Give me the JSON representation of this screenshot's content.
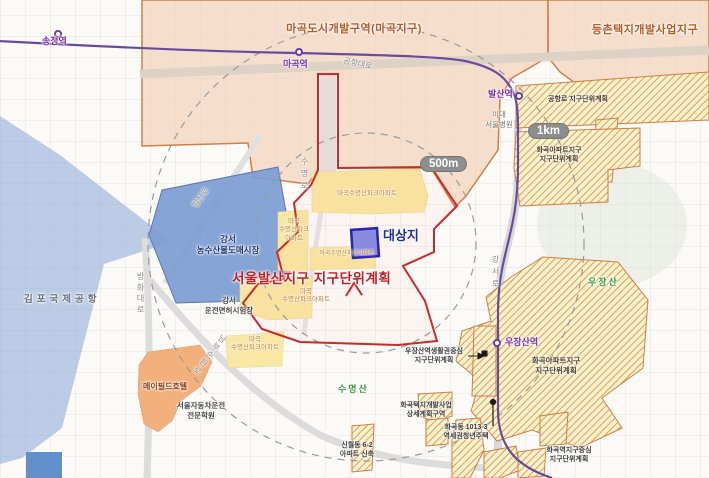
{
  "map": {
    "plan_title": "서울발산지구 지구단위계획",
    "target_site": "대상지",
    "badges": {
      "radius_500m": "500m",
      "radius_1km": "1km"
    },
    "development_zones": {
      "magok": "마곡도시개발구역(마곡지구)",
      "deungchon": "등촌택지개발사업지구"
    },
    "district_plans": {
      "gonghangro": "공항로 지구단위계획",
      "hwagok_apt_north": {
        "line1": "화곡아파트지구",
        "line2": "지구단위계획"
      },
      "hwagok_apt_south": {
        "line1": "화곡아파트지구",
        "line2": "지구단위계획"
      },
      "ujangsan_station_area": {
        "line1": "우장산역생활권중심",
        "line2": "지구단위계획"
      },
      "hwagok_detail": {
        "line1": "화곡택지개발사업",
        "line2": "상세계획구역"
      },
      "hwagok_youth_housing": {
        "line1": "화곡동 1013-3",
        "line2": "역세권청년주택"
      },
      "sinwol_apt": {
        "line1": "신월동 6-2",
        "line2": "아파트 신축"
      },
      "hwagok_station_center": {
        "line1": "화곡역지구중심",
        "line2": "지구단위계획"
      }
    },
    "stations": {
      "songjeong": "송정역",
      "magok": "마곡역",
      "balsan": "발산역",
      "ujangsan": "우장산역"
    },
    "roads": {
      "gonghang_daero": "공항대로",
      "balsan_ro": "발산로",
      "banghwa_daero": "방화대로",
      "nambu_circular": "남부순환로",
      "sumyeong_ro": "수명로",
      "gangseo_ro": "강서로"
    },
    "places": {
      "gimpo_airport": "김포국제공항",
      "agro_market": {
        "line1": "강서",
        "line2": "농수산물도매시장"
      },
      "license_test_center": {
        "line1": "강서",
        "line2": "운전면허시험장"
      },
      "mayfield_hotel": "메이필드호텔",
      "driving_school": {
        "line1": "서울자동차운전",
        "line2": "전문학원"
      },
      "ewha_hospital": {
        "line1": "이대",
        "line2": "서울병원"
      },
      "mt_ujangsan": "우장산",
      "mt_sumyeongsan": "수명산"
    },
    "apartments": {
      "name_full": "마곡수명산파크아파트",
      "name_l1": "마곡",
      "name_l2": "수명산파크",
      "name_l3": "아파트",
      "name_l2l3": "수명산파크아파트"
    },
    "colors": {
      "zone_fill": "#f3d4bb",
      "zone_border": "#cf7f44",
      "hatch_stripe": "#dd9544",
      "plan_boundary_red": "#c92a2a",
      "subway_purple": "#6a4aa0",
      "target_blue": "#2626b0",
      "apartment_yellow": "#f9e7a4",
      "market_blue": "#7d9cd2",
      "mountain_green": "#3f9c44"
    }
  }
}
